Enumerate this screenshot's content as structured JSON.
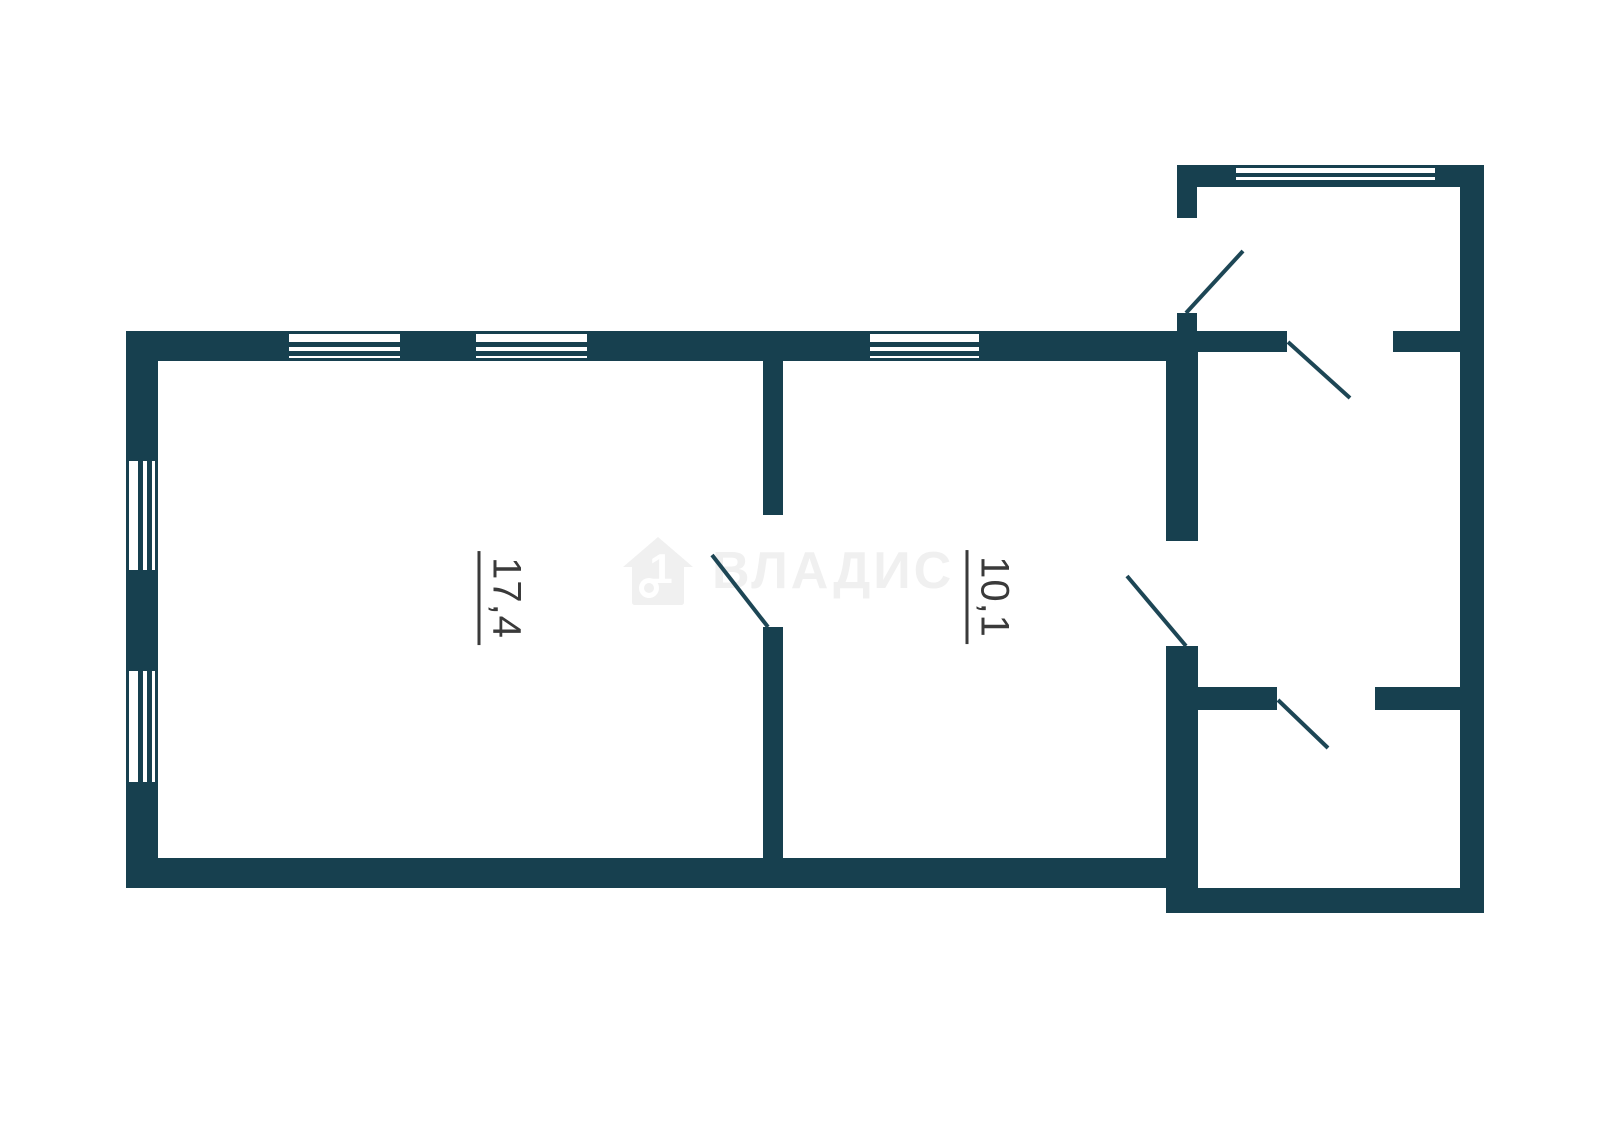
{
  "watermark": {
    "brand": "ВЛАДИС",
    "icon": "vladis-house-logo"
  },
  "rooms": [
    {
      "id": "room-1",
      "area_label": "17,4"
    },
    {
      "id": "room-2",
      "area_label": "10,1"
    }
  ],
  "colors": {
    "wall": "#17404f",
    "background": "#ffffff",
    "door_line": "#1d4655",
    "room_label": "#3a3a3a",
    "watermark": "#f0f0f0"
  }
}
